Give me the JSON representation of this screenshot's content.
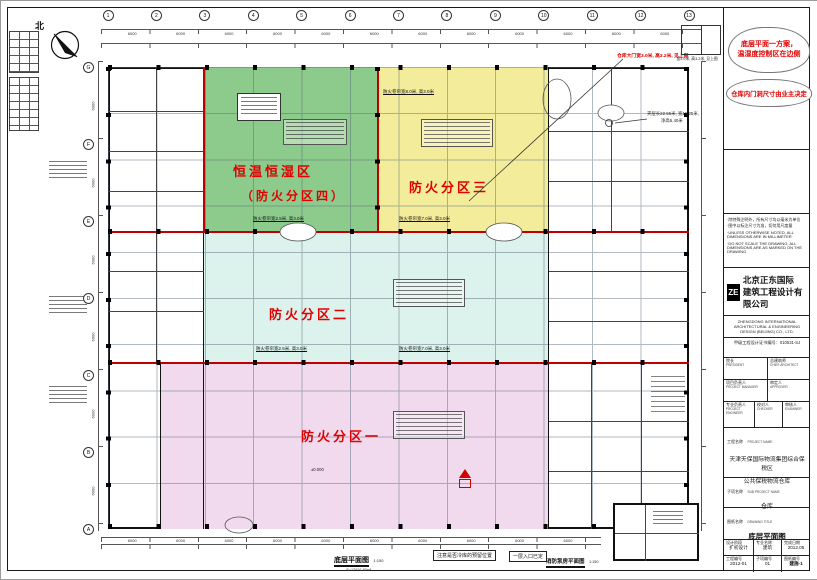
{
  "compass": {
    "label": "北"
  },
  "axes": {
    "top_numbers": [
      "1",
      "2",
      "3",
      "4",
      "5",
      "6",
      "7",
      "8",
      "9",
      "10",
      "11",
      "12",
      "13"
    ],
    "left_letters": [
      "G",
      "F",
      "E",
      "D",
      "C",
      "B",
      "A"
    ],
    "dim_label": "6000"
  },
  "revision_clouds": {
    "note1_line1": "底层平面一方案，",
    "note1_line2": "温湿度控制区在边侧",
    "note2": "仓库内门洞尺寸由业主决定"
  },
  "plan_notes": {
    "gate_note": "仓库大门宽3.0米, 高3.2米, 见上图",
    "gate_sketch_caption": "宽3.0米, 高3.2米, 见上图",
    "mezzanine_line1": "夹层长22.55米, 宽16.25米,",
    "mezzanine_line2": "净高5.40米",
    "elevation_label": "±0.000",
    "shutter_w80": "防火卷帘宽8.0米, 高3.0米",
    "shutter_w25": "防火卷帘宽2.5米, 高3.0米",
    "shutter_w70": "防火卷帘宽7.0米, 高3.0米"
  },
  "zones": {
    "zone4_line1": "恒温恒湿区",
    "zone4_line2": "（防火分区四）",
    "zone3_label": "防火分区三",
    "zone2_label": "防火分区二",
    "zone1_label": "防火分区一",
    "colors": {
      "zone4": "#8ccb8c",
      "zone3": "#f3ec9b",
      "zone2": "#dcf2ec",
      "zone1": "#f2daee",
      "fire_wall": "#c00000",
      "label_red": "#e00000"
    }
  },
  "bottom_labels": {
    "plan_title": "底层平面图",
    "plan_scale": "1:150",
    "plan_area": "S=12916.80m²",
    "coldstore_note": "注意是否冷库的预留位置",
    "entrance_note": "一层入口已定",
    "pump_title": "消防泵房平面图",
    "pump_scale": "1:150"
  },
  "titleblock": {
    "company": {
      "logo": "ZE",
      "cn1": "北京正东国际",
      "cn2": "建筑工程设计有限公司",
      "en1": "ZHENGDONG INTERNATIONAL",
      "en2": "ARCHITECTURAL & ENGINEERING",
      "en3": "DESIGN (BEIJING) CO., LTD.",
      "cert": "甲级工程设计证书编号：010531-SJ"
    },
    "notes": [
      "·除特殊注明外，所有尺寸均以毫米为单位",
      "·图中以标注尺寸为准，切勿用尺度量",
      "·UNLESS OTHERWISE NOTED, ALL DIMENSIONS ARE IN MILLIMETER",
      "·DO NOT SCALE THE DRAWING, ALL DIMENSIONS ARE AS MARKED ON THE DRAWING"
    ],
    "personnel": {
      "r1c1_cn": "院长",
      "r1c1_en": "PRESIDENT",
      "r1c2_cn": "总建筑师",
      "r1c2_en": "CHIEF ARCHITECT",
      "r2c1_cn": "项目负责人",
      "r2c1_en": "PROJECT MANAGER",
      "r2c2_cn": "审定人",
      "r2c2_en": "APPROVER",
      "r3c1_cn": "专业负责人",
      "r3c1_en": "PROJECT ENGINEER",
      "r3c2_cn": "校对人",
      "r3c2_en": "CHECKER",
      "r3c3_cn": "审核人",
      "r3c3_en": "EXAMINER"
    },
    "project": {
      "label_cn": "工程名称",
      "label_en": "PROJECT NAME",
      "value1": "天津天保国际物流集团综合保税区",
      "value2": "公共保税物流仓库"
    },
    "subproject": {
      "label_cn": "子项名称",
      "label_en": "SUB PROJECT NAME",
      "value": "仓库"
    },
    "drawing": {
      "label_cn": "图纸名称",
      "label_en": "DRAWING TITLE",
      "value": "底层平面图"
    },
    "meta": {
      "phase_cn": "设计阶段",
      "phase_en": "DESIGN PHASE",
      "phase_val": "扩初设计",
      "spec_cn": "专业名称",
      "spec_en": "SPECIALTY",
      "spec_val": "建筑",
      "date_cn": "完成日期",
      "date_en": "WORKING DATE",
      "date_val": "2012.05",
      "projno_cn": "工程编号",
      "projno_en": "PROJECT NO.",
      "projno_val": "2012-01",
      "subno_cn": "子项编号",
      "subno_en": "SUB PROJECT NO.",
      "subno_val": "01",
      "dwgno_cn": "图纸编号",
      "dwgno_en": "DRAWING NO.",
      "dwgno_val": "建施-1"
    }
  }
}
